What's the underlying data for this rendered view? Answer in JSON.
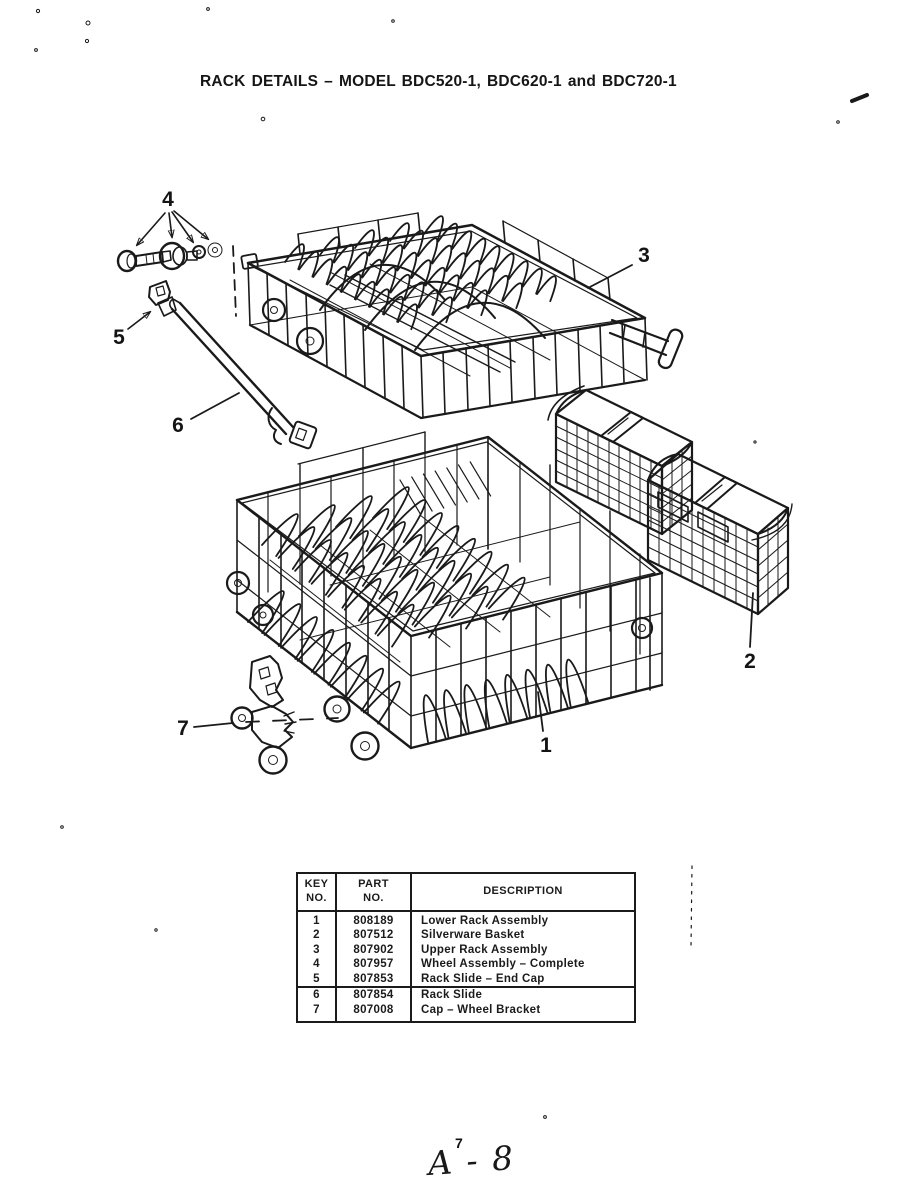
{
  "page": {
    "title": "RACK DETAILS – MODEL BDC520-1, BDC620-1 and BDC720-1",
    "footer": {
      "page_number": "7",
      "handwritten": "A - 8"
    }
  },
  "diagram": {
    "callouts": [
      "1",
      "2",
      "3",
      "4",
      "5",
      "6",
      "7"
    ]
  },
  "parts_table": {
    "headers": {
      "key": "KEY\nNO.",
      "part": "PART\nNO.",
      "description": "DESCRIPTION"
    },
    "rows": [
      {
        "key": "1",
        "part": "808189",
        "description": "Lower Rack Assembly"
      },
      {
        "key": "2",
        "part": "807512",
        "description": "Silverware Basket"
      },
      {
        "key": "3",
        "part": "807902",
        "description": "Upper Rack Assembly"
      },
      {
        "key": "4",
        "part": "807957",
        "description": "Wheel Assembly – Complete"
      },
      {
        "key": "5",
        "part": "807853",
        "description": "Rack Slide – End Cap"
      },
      {
        "key": "6",
        "part": "807854",
        "description": "Rack Slide"
      },
      {
        "key": "7",
        "part": "807008",
        "description": "Cap – Wheel Bracket"
      }
    ]
  }
}
